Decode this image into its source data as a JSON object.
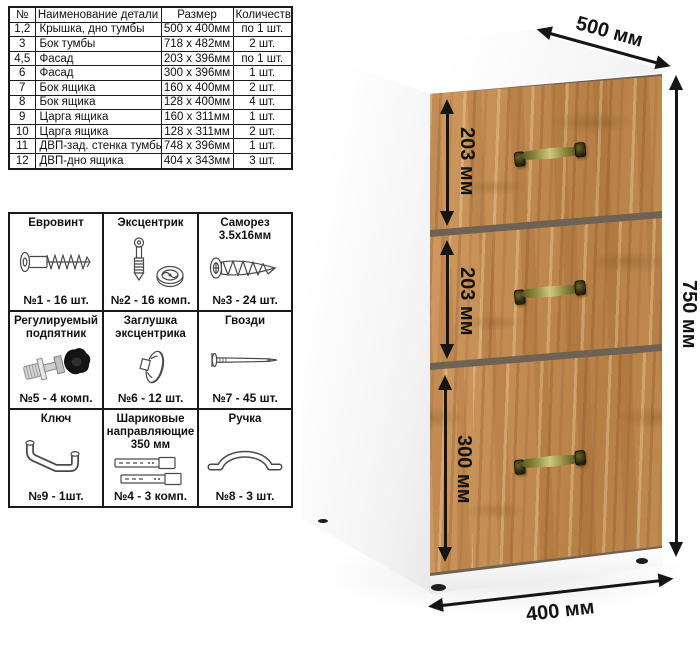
{
  "parts_table": {
    "headers": [
      "№",
      "Наименование детали",
      "Размер",
      "Количество"
    ],
    "rows": [
      [
        "1,2",
        "Крышка, дно тумбы",
        "500 х 400мм",
        "по 1 шт."
      ],
      [
        "3",
        "Бок тумбы",
        "718 х 482мм",
        "2 шт."
      ],
      [
        "4,5",
        "Фасад",
        "203 х 396мм",
        "по 1 шт."
      ],
      [
        "6",
        "Фасад",
        "300 х 396мм",
        "1 шт."
      ],
      [
        "7",
        "Бок ящика",
        "160 х 400мм",
        "2 шт."
      ],
      [
        "8",
        "Бок ящика",
        "128 х 400мм",
        "4 шт."
      ],
      [
        "9",
        "Царга ящика",
        "160 х 311мм",
        "1 шт."
      ],
      [
        "10",
        "Царга ящика",
        "128 х 311мм",
        "2 шт."
      ],
      [
        "11",
        "ДВП-зад. стенка тумбы",
        "748 х 396мм",
        "1 шт."
      ],
      [
        "12",
        "ДВП-дно ящика",
        "404 х 343мм",
        "3 шт."
      ]
    ]
  },
  "hardware_grid": {
    "items": [
      {
        "title": "Евровинт",
        "count": "№1 - 16 шт.",
        "icon": "euro-screw-icon"
      },
      {
        "title": "Эксцентрик",
        "count": "№2 - 16 комп.",
        "icon": "cam-lock-icon"
      },
      {
        "title": "Саморез 3.5х16мм",
        "count": "№3 - 24 шт.",
        "icon": "self-tapping-screw-icon"
      },
      {
        "title": "Регулируемый подпятник",
        "count": "№5 - 4 комп.",
        "icon": "adjustable-foot-icon"
      },
      {
        "title": "Заглушка эксцентрика",
        "count": "№6 - 12 шт.",
        "icon": "cam-cap-icon"
      },
      {
        "title": "Гвозди",
        "count": "№7 - 45 шт.",
        "icon": "nail-icon"
      },
      {
        "title": "Ключ",
        "count": "№9 - 1шт.",
        "icon": "hex-key-icon"
      },
      {
        "title": "Шариковые направляющие 350 мм",
        "count": "№4 - 3 комп.",
        "icon": "drawer-slides-icon"
      },
      {
        "title": "Ручка",
        "count": "№8 - 3 шт.",
        "icon": "pull-handle-icon"
      }
    ]
  },
  "cabinet": {
    "dim_depth": "500 мм",
    "dim_height": "750 мм",
    "dim_width": "400 мм",
    "drawer_dims": [
      "203 мм",
      "203 мм",
      "300 мм"
    ],
    "drawer_count": "3"
  },
  "colors": {
    "wood_base": "#c08a50",
    "handle_bronze": "#8d873c",
    "dimension_arrow": "#151515",
    "table_border": "#1a1a1a"
  }
}
